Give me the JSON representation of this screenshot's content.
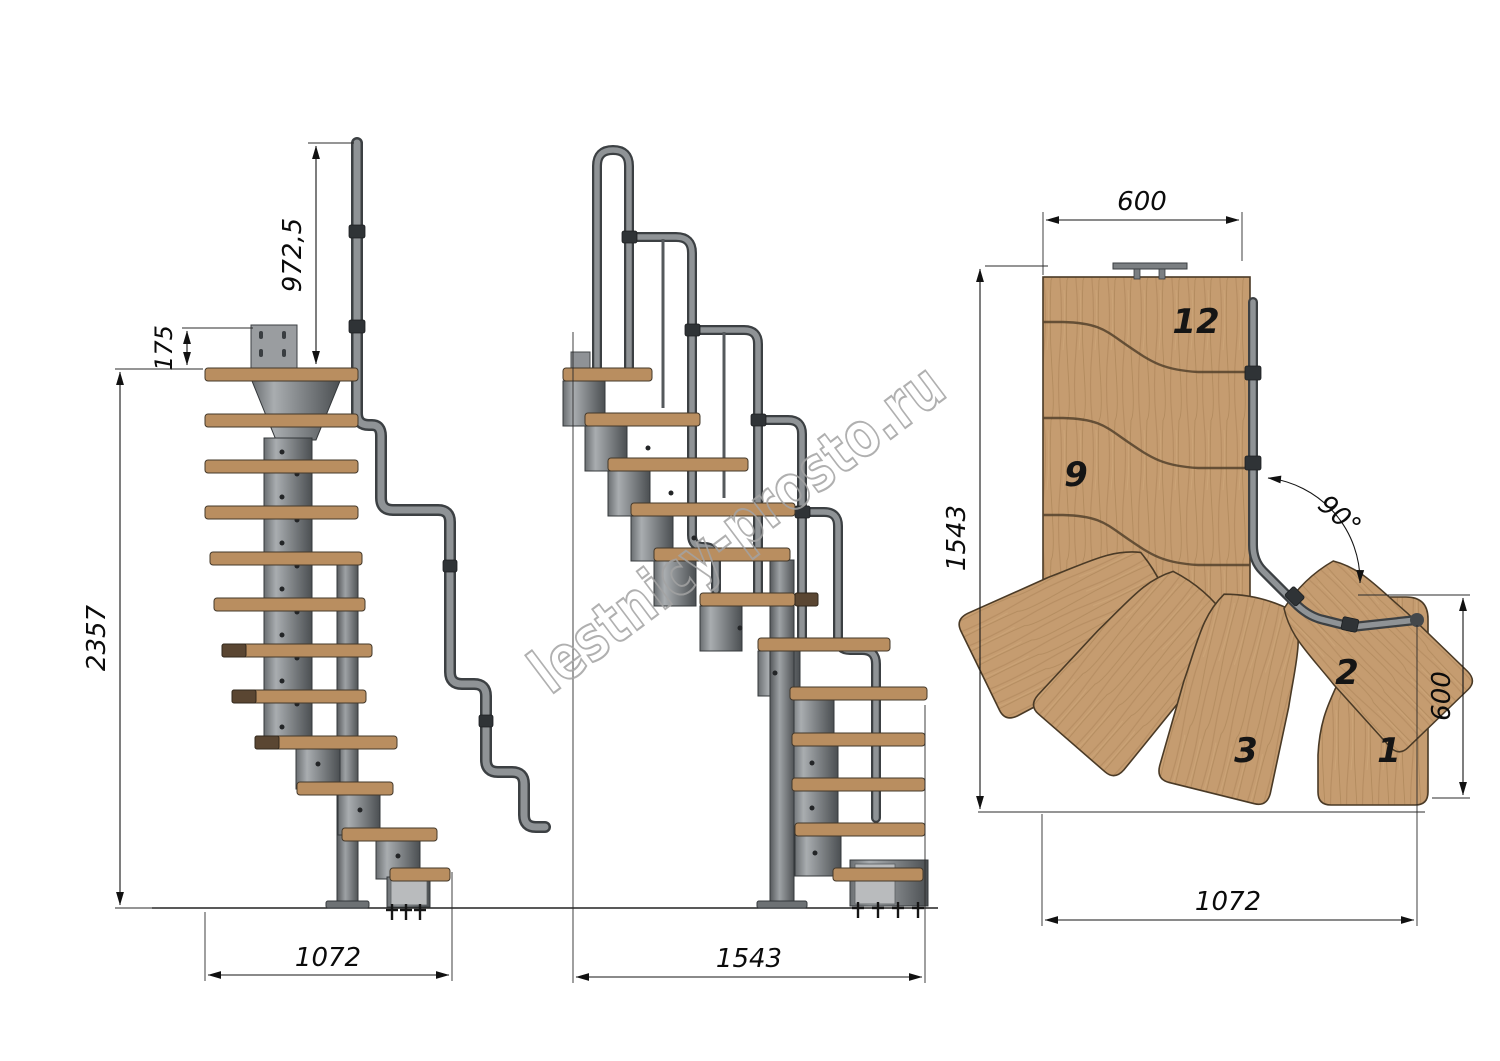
{
  "meta": {
    "drawing_type": "modular staircase technical drawing",
    "views": [
      "side elevation",
      "front elevation",
      "plan view"
    ]
  },
  "watermark": {
    "text": "lestnicy-prosto.ru",
    "color": "#a3a3a3"
  },
  "side_view": {
    "name": "side elevation",
    "dims": {
      "handrail_post_height": "972,5",
      "bracket_height": "175",
      "total_height": "2357",
      "footprint_length": "1072"
    }
  },
  "front_view": {
    "name": "front elevation",
    "dims": {
      "footprint_length": "1543"
    }
  },
  "plan_view": {
    "name": "plan view",
    "dims": {
      "flight_width": "600",
      "plan_depth": "1543",
      "turn_angle": "90°",
      "entry_width": "600",
      "plan_length": "1072"
    },
    "tread_labels": {
      "top_tread": "12",
      "upper_flight_tread": "9",
      "winder_upper": "2",
      "winder_lower": "3",
      "first_tread": "1"
    }
  },
  "colors": {
    "wood": "#c59c70",
    "wood_side": "#b98e60",
    "wood_dark": "#a07a4e",
    "metal_light": "#8f9396",
    "metal_dark": "#3c4043",
    "dimension": "#141414",
    "background": "#ffffff"
  }
}
